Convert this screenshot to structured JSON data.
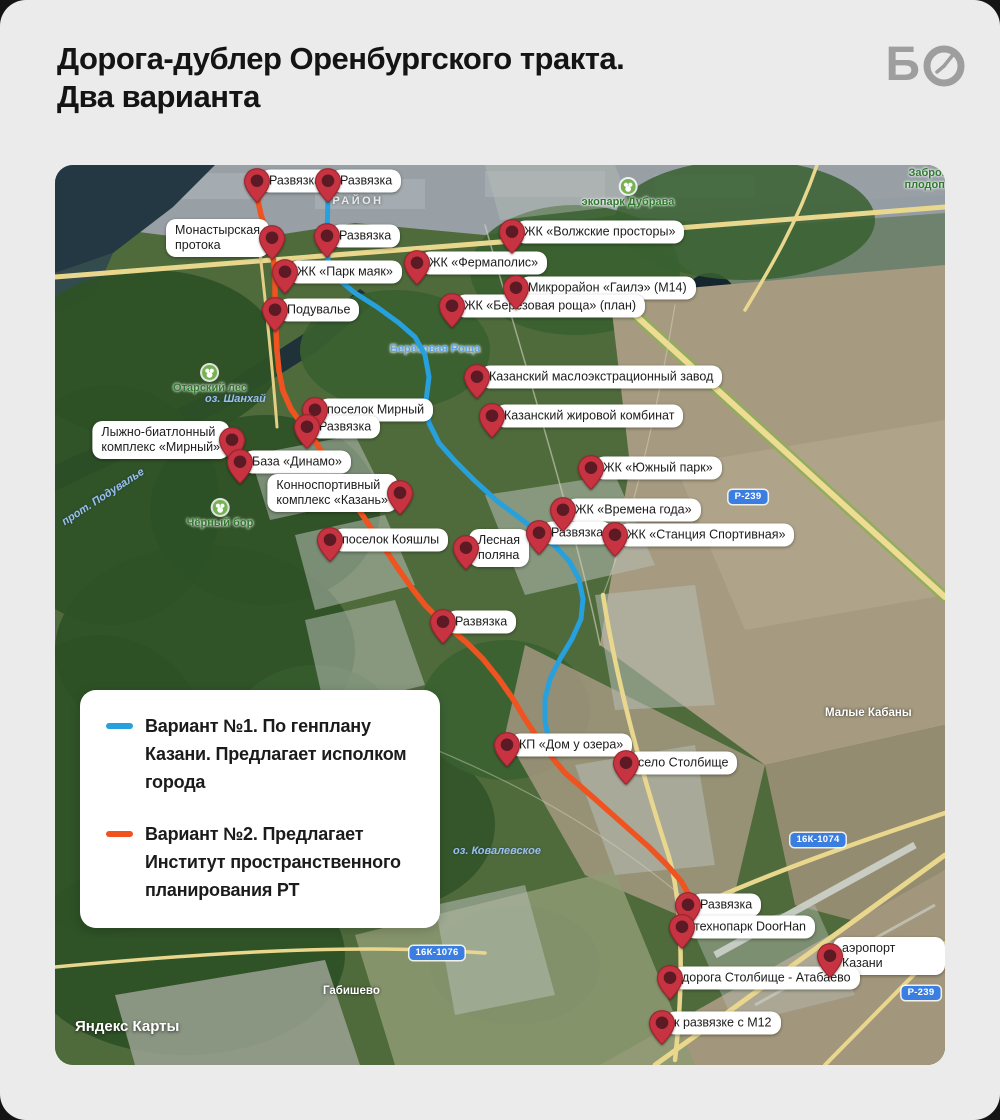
{
  "header": {
    "title_line1": "Дорога-дублер Оренбургского тракта.",
    "title_line2": "Два варианта",
    "logo_letter": "Б"
  },
  "legend": {
    "items": [
      {
        "color": "#27a0de",
        "label": "Вариант №1. По генплану Казани. Предлагает исполком города"
      },
      {
        "color": "#ef5320",
        "label": "Вариант №2. Предлагает Институт пространственного планирования РТ"
      }
    ]
  },
  "map": {
    "attribution": "Яндекс Карты",
    "pin_color": "#c73340",
    "pin_inner_color": "#5c1a24",
    "routes": [
      {
        "id": "variant-1",
        "name": "Вариант №1",
        "color": "#27a0de",
        "width": 5,
        "points": [
          [
            273,
            31
          ],
          [
            272,
            71
          ],
          [
            273,
            95
          ],
          [
            282,
            113
          ],
          [
            300,
            128
          ],
          [
            322,
            142
          ],
          [
            344,
            158
          ],
          [
            360,
            172
          ],
          [
            370,
            190
          ],
          [
            374,
            212
          ],
          [
            371,
            236
          ],
          [
            374,
            258
          ],
          [
            384,
            278
          ],
          [
            400,
            296
          ],
          [
            420,
            316
          ],
          [
            442,
            336
          ],
          [
            466,
            354
          ],
          [
            484,
            368
          ],
          [
            500,
            381
          ],
          [
            514,
            396
          ],
          [
            524,
            414
          ],
          [
            528,
            434
          ],
          [
            526,
            454
          ],
          [
            517,
            474
          ],
          [
            505,
            494
          ],
          [
            495,
            514
          ],
          [
            490,
            534
          ],
          [
            490,
            556
          ],
          [
            494,
            576
          ],
          [
            500,
            592
          ]
        ]
      },
      {
        "id": "variant-2",
        "name": "Вариант №2",
        "color": "#ef5320",
        "width": 5.5,
        "points": [
          [
            202,
            31
          ],
          [
            206,
            50
          ],
          [
            212,
            68
          ],
          [
            216,
            73
          ],
          [
            218,
            90
          ],
          [
            220,
            110
          ],
          [
            220,
            130
          ],
          [
            220,
            146
          ],
          [
            221,
            166
          ],
          [
            222,
            186
          ],
          [
            224,
            206
          ],
          [
            228,
            226
          ],
          [
            236,
            244
          ],
          [
            246,
            258
          ],
          [
            252,
            263
          ],
          [
            260,
            276
          ],
          [
            272,
            295
          ],
          [
            286,
            317
          ],
          [
            300,
            339
          ],
          [
            314,
            360
          ],
          [
            328,
            381
          ],
          [
            342,
            402
          ],
          [
            356,
            422
          ],
          [
            370,
            440
          ],
          [
            382,
            452
          ],
          [
            388,
            458
          ],
          [
            398,
            466
          ],
          [
            412,
            478
          ],
          [
            428,
            494
          ],
          [
            444,
            514
          ],
          [
            458,
            534
          ],
          [
            470,
            554
          ],
          [
            482,
            572
          ],
          [
            492,
            586
          ],
          [
            500,
            596
          ],
          [
            510,
            608
          ],
          [
            524,
            620
          ],
          [
            540,
            634
          ],
          [
            558,
            650
          ],
          [
            576,
            666
          ],
          [
            594,
            682
          ],
          [
            612,
            700
          ],
          [
            626,
            716
          ],
          [
            634,
            730
          ],
          [
            636,
            742
          ]
        ]
      }
    ],
    "pins": [
      {
        "label": "Развязка",
        "x": 202,
        "y": 16,
        "side": "right"
      },
      {
        "label": "Развязка",
        "x": 273,
        "y": 16,
        "side": "right"
      },
      {
        "label": "Монастырская\nпротока",
        "x": 217,
        "y": 73,
        "side": "left"
      },
      {
        "label": "Развязка",
        "x": 272,
        "y": 71,
        "side": "right"
      },
      {
        "label": "ЖК «Парк маяк»",
        "x": 230,
        "y": 107,
        "side": "right"
      },
      {
        "label": "ЖК «Фермаполис»",
        "x": 362,
        "y": 98,
        "side": "right"
      },
      {
        "label": "ЖК «Волжские просторы»",
        "x": 457,
        "y": 67,
        "side": "right"
      },
      {
        "label": "Микрорайон «Гаилэ» (М14)",
        "x": 461,
        "y": 123,
        "side": "right"
      },
      {
        "label": "ЖК «Березовая роща» (план)",
        "x": 397,
        "y": 141,
        "side": "right"
      },
      {
        "label": "Подувалье",
        "x": 220,
        "y": 145,
        "side": "right"
      },
      {
        "label": "Казанский маслоэкстрационный завод",
        "x": 422,
        "y": 212,
        "side": "right"
      },
      {
        "label": "поселок Мирный",
        "x": 260,
        "y": 245,
        "side": "right"
      },
      {
        "label": "Развязка",
        "x": 252,
        "y": 262,
        "side": "right"
      },
      {
        "label": "Казанский жировой комбинат",
        "x": 437,
        "y": 251,
        "side": "right"
      },
      {
        "label": "Лыжно-биатлонный\nкомплекс «Мирный»",
        "x": 177,
        "y": 275,
        "side": "left"
      },
      {
        "label": "База «Динамо»",
        "x": 185,
        "y": 297,
        "side": "right"
      },
      {
        "label": "ЖК «Южный парк»",
        "x": 536,
        "y": 303,
        "side": "right"
      },
      {
        "label": "Конноспортивный\nкомплекс «Казань»",
        "x": 345,
        "y": 328,
        "side": "left"
      },
      {
        "label": "ЖК «Времена года»",
        "x": 508,
        "y": 345,
        "side": "right"
      },
      {
        "label": "Развязка",
        "x": 484,
        "y": 368,
        "side": "right"
      },
      {
        "label": "ЖК «Станция Спортивная»",
        "x": 560,
        "y": 370,
        "side": "right"
      },
      {
        "label": "поселок Кояшлы",
        "x": 275,
        "y": 375,
        "side": "right"
      },
      {
        "label": "Лесная\nполяна",
        "x": 411,
        "y": 383,
        "side": "right"
      },
      {
        "label": "Развязка",
        "x": 388,
        "y": 457,
        "side": "right"
      },
      {
        "label": "КП «Дом у озера»",
        "x": 452,
        "y": 580,
        "side": "right"
      },
      {
        "label": "село Столбище",
        "x": 571,
        "y": 598,
        "side": "right"
      },
      {
        "label": "Развязка",
        "x": 633,
        "y": 740,
        "side": "right"
      },
      {
        "label": "технопарк DoorHan",
        "x": 627,
        "y": 762,
        "side": "right"
      },
      {
        "label": "аэропорт Казани",
        "x": 775,
        "y": 791,
        "side": "right"
      },
      {
        "label": "дорога Столбище - Атабаево",
        "x": 615,
        "y": 813,
        "side": "right"
      },
      {
        "label": "к развязке с М12",
        "x": 607,
        "y": 858,
        "side": "right"
      }
    ],
    "labels": [
      {
        "type": "district",
        "text": "ВОЛЖСКИЙ\nРАЙОН",
        "x": 303,
        "y": 18
      },
      {
        "type": "park",
        "text": "экопарк Дубрава",
        "x": 573,
        "y": 14
      },
      {
        "type": "park",
        "text": "Заброшенный плодопитомник",
        "x": 845,
        "y": 2,
        "w": 95,
        "icon": false
      },
      {
        "type": "park",
        "text": "Отарский лес",
        "x": 155,
        "y": 200
      },
      {
        "type": "water",
        "text": "оз. Шанхай",
        "x": 150,
        "y": 228
      },
      {
        "type": "station",
        "text": "Берёзовая Роща",
        "x": 335,
        "y": 178
      },
      {
        "type": "park",
        "text": "Чёрный бор",
        "x": 165,
        "y": 335
      },
      {
        "type": "water",
        "text": "прот. Подувалье",
        "x": 8,
        "y": 352,
        "rotate": -33
      },
      {
        "type": "town",
        "text": "Малые Кабаны",
        "x": 770,
        "y": 542
      },
      {
        "type": "water",
        "text": "оз. Ковалевское",
        "x": 398,
        "y": 680
      },
      {
        "type": "town",
        "text": "Габишево",
        "x": 268,
        "y": 820
      }
    ],
    "shields": [
      {
        "text": "Р-239",
        "x": 693,
        "y": 332
      },
      {
        "text": "16К-1074",
        "x": 763,
        "y": 675
      },
      {
        "text": "16К-1076",
        "x": 382,
        "y": 788
      },
      {
        "text": "Р-239",
        "x": 866,
        "y": 828
      }
    ]
  }
}
